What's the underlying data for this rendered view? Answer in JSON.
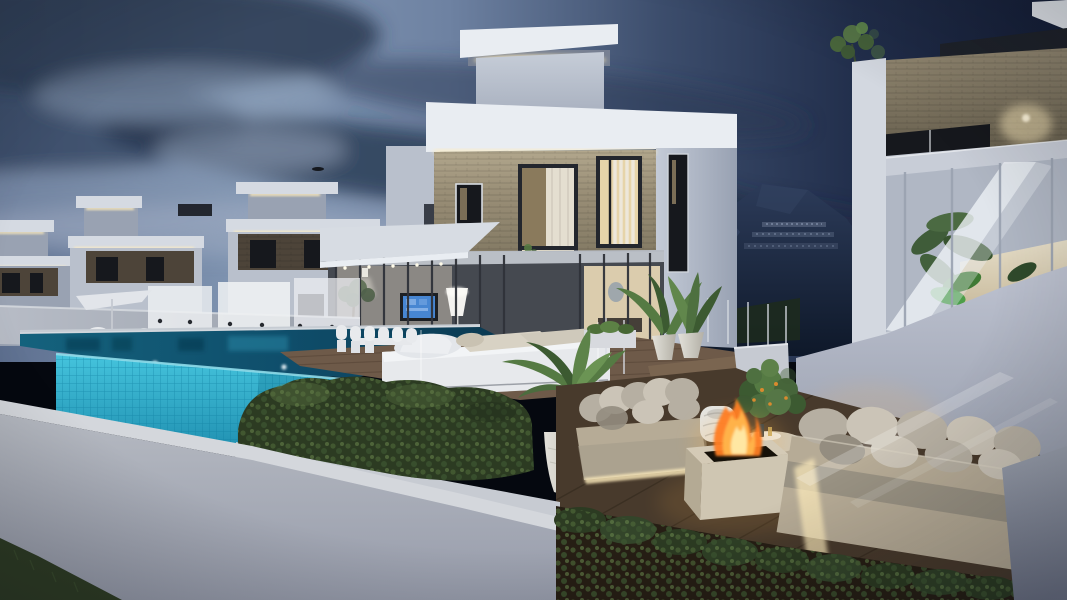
{
  "scene": {
    "type": "3d-architectural-render",
    "time_of_day": "dusk",
    "subject": "modern white luxury villas with infinity pool, wooden deck terraces, outdoor lounge with fire pit, mountain backdrop",
    "visible_text": "none"
  },
  "palette": {
    "sky_left": "#5e7090",
    "sky_midlight": "#8196b3",
    "sky_right": "#161f38",
    "cloud_dark": "#2a3852",
    "cloud_darker": "#1f2c46",
    "cloud_light": "#8ea0b8",
    "haze_light": "#aab5c8",
    "mountain_top": "#2c3b59",
    "mountain_base": "#0e1829",
    "distant_building": "#4b5872",
    "distant_window": "#93a2bd",
    "villa_bright": "#e9edf2",
    "villa_light": "#d5dae2",
    "villa_mid": "#b9c0cc",
    "villa_dim": "#99a2b2",
    "villa_dark": "#7e8797",
    "led_warm": "#ffedbd",
    "stone_light": "#b2a78d",
    "stone_mid": "#8a806b",
    "stone_dark": "#6b6250",
    "stone_brown": "#4d4439",
    "win_dark": "#16181d",
    "win_warm": "#e6d4a9",
    "win_warm_dim": "#bfa87e",
    "curtain": "#e9e4d6",
    "tv_screen": "#3c7fd0",
    "pool_face": "#3abfdb",
    "pool_face_deep": "#1f8fb0",
    "pool_lip": "#8fdbe9",
    "water_top": "#14627d",
    "water_dark": "#0b3a52",
    "deck_wood": "#6e5a49",
    "deck_plank": "#544334",
    "deck_low": "#483a2c",
    "deck_low_plank": "#33281d",
    "sofa_base": "#b6ab96",
    "cushion": "#b6afa2",
    "cushion_light": "#cbc4b7",
    "cushion_dark": "#948d80",
    "lounger": "#e7e9ec",
    "lounger_shadow": "#c2c6cd",
    "pot_white": "#dcd9d1",
    "pot_shadow": "#b3b0a6",
    "palm_green": "#557a43",
    "palm_green_dark": "#3c5a31",
    "hedge_base": "#2c3b22",
    "hedge_light": "#4e6838",
    "hedge_lighter": "#647f48",
    "grass": "#2f3d25",
    "soil": "#261e14",
    "wall_top": "#d4d7dc",
    "wall_face": "#b5b9c1",
    "wall_face_dark": "#979cab",
    "grey_corner": "#8a909d",
    "fire_core": "#ffeaa6",
    "fire_mid": "#ffb54d",
    "fire_deep": "#ff7d22",
    "pit_black": "#161109",
    "travertine": "#d4cab6",
    "travertine_dark": "#b4aa94",
    "frame_dark": "#23262d",
    "fruit_orange": "#d98a2e"
  },
  "objects": [
    "dusk-sky",
    "cloud-bank",
    "mountain",
    "distant-hillside-buildings",
    "row-of-white-villas",
    "rooftop-light-boxes",
    "led-cove-lighting",
    "main-villa",
    "stone-cladding",
    "lit-picture-windows",
    "vertical-curtains",
    "covered-terrace",
    "wall-mounted-tv",
    "white-floor-lamp",
    "dining-chairs",
    "parasol",
    "infinity-pool",
    "glass-tile-pool-wall",
    "underwater-lights",
    "wooden-pool-deck",
    "white-daybed",
    "conical-planter-with-palm",
    "potted-areca-palms",
    "deck-steps",
    "lower-lounge-deck",
    "outdoor-sofas",
    "square-fire-pit",
    "flames",
    "round-coffee-table",
    "wicker-basket-chair",
    "citrus-shrub",
    "right-villa",
    "glass-balustrade",
    "terrace-plants",
    "wall-sconce-glow",
    "garden-hedge",
    "hedgerow-strip",
    "boundary-wall",
    "lawn-patch"
  ]
}
